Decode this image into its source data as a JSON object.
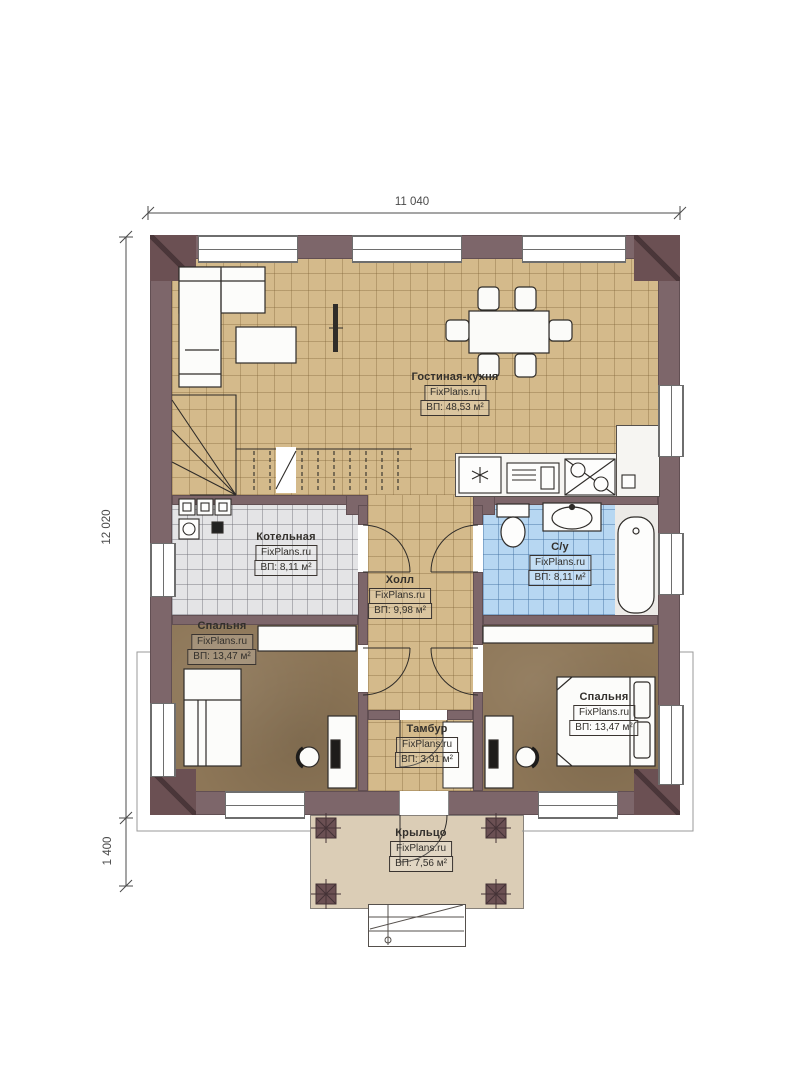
{
  "dimensions": {
    "top": "11 040",
    "left": "12 020",
    "bottom_left": "1 400"
  },
  "rooms": [
    {
      "name": "Гостиная-кухня",
      "watermark": "FixPlans.ru",
      "area": "ВП: 48,53 м²"
    },
    {
      "name": "Котельная",
      "watermark": "FixPlans.ru",
      "area": "ВП: 8,11 м²"
    },
    {
      "name": "С/у",
      "watermark": "FixPlans.ru",
      "area": "ВП: 8,11 м²"
    },
    {
      "name": "Холл",
      "watermark": "FixPlans.ru",
      "area": "ВП: 9,98 м²"
    },
    {
      "name": "Спальня",
      "watermark": "FixPlans.ru",
      "area": "ВП: 13,47 м²"
    },
    {
      "name": "Спальня",
      "watermark": "FixPlans.ru",
      "area": "ВП: 13,47 м²"
    },
    {
      "name": "Тамбур",
      "watermark": "FixPlans.ru",
      "area": "ВП: 3,91 м²"
    },
    {
      "name": "Крыльцо",
      "watermark": "FixPlans.ru",
      "area": "ВП: 7,56 м²"
    }
  ],
  "colors": {
    "wall": "#7d666a",
    "wall_dark": "#6b5053",
    "floor_tile_tan": "#d4ba8b",
    "floor_gray": "#e4e4e6",
    "floor_blue": "#b7d7f2",
    "floor_brown": "#8d7657",
    "floor_porch": "#dbcdb6",
    "dim": "#4b4b4b"
  }
}
